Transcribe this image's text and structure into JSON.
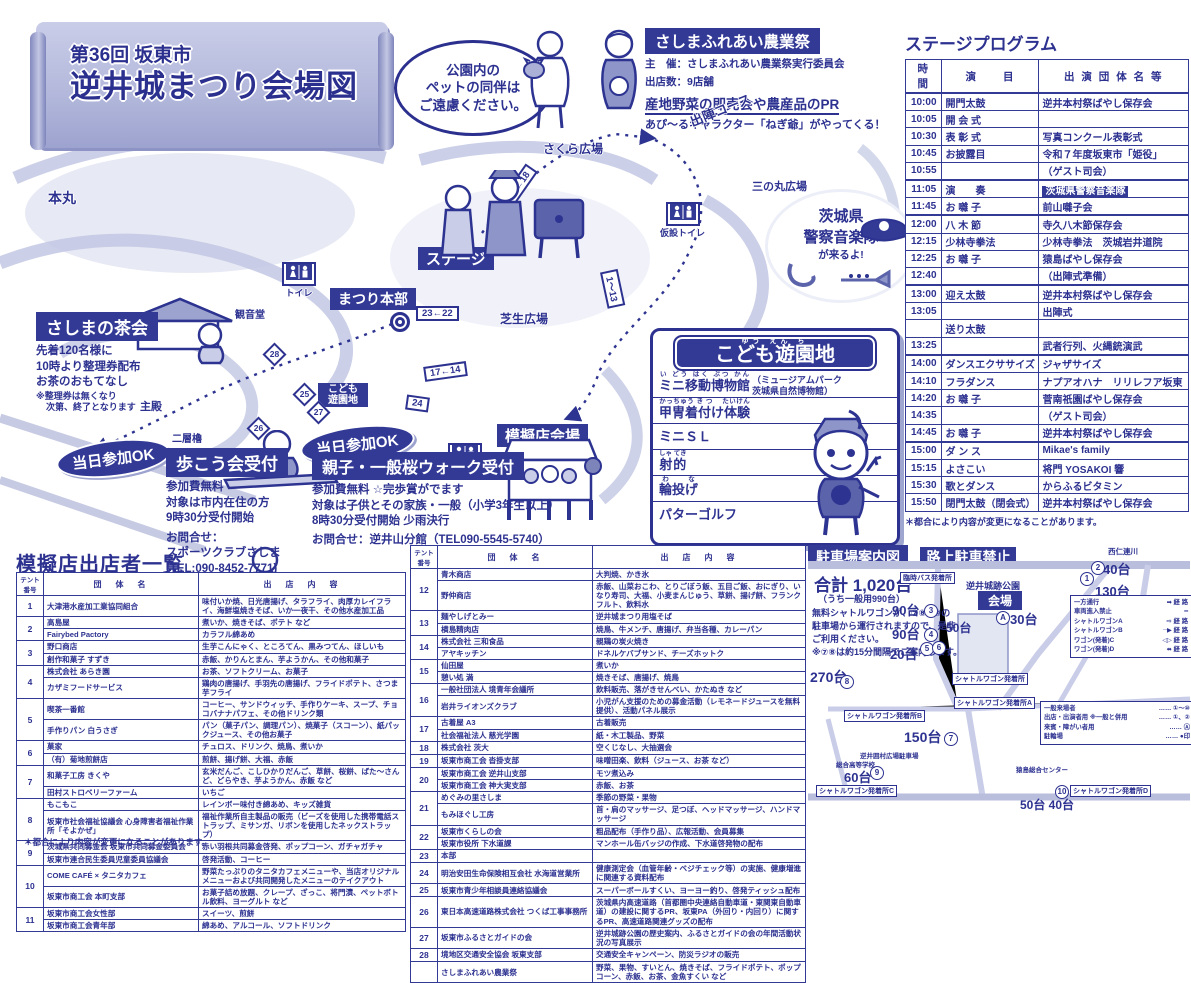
{
  "title": {
    "line1": "第36回 坂東市",
    "line2": "逆井城まつり会場図"
  },
  "pet_notice": {
    "line1": "公園内の",
    "line2": "ペットの同伴は",
    "line3": "ご遠慮ください。"
  },
  "farm_festival": {
    "title": "さしまふれあい農業祭",
    "organizer": "主　催：さしまふれあい農業祭実行委員会",
    "booths": "出店数：9店舗",
    "highlight": "産地野菜の即売会や農産品のPR",
    "note": "あぴ〜るキャラクター「ねぎ爺」がやってくる！"
  },
  "band_balloon": {
    "line1": "茨城県",
    "line2": "警察音楽隊",
    "line3": "が来るよ!"
  },
  "map": {
    "labels": {
      "honmaru": "本丸",
      "sakura": "さくら広場",
      "sannomaru": "三の丸広場",
      "course": "出陣コース",
      "stage": "ステージ",
      "hq": "まつり本部",
      "lawn": "芝生広場",
      "mogiten": "模擬店会場",
      "kannondo": "観音堂",
      "shuden": "主殿",
      "yagura": "二層櫓",
      "toilet": "トイレ",
      "kasetsu1": "仮設トイレ",
      "kasetsu2": "仮設トイレ",
      "kids_small": "こども遊園地"
    },
    "markers": [
      "21←18",
      "23←22",
      "17←14",
      "24",
      "25",
      "26",
      "27",
      "28",
      "1〜13"
    ]
  },
  "tea_party": {
    "title": "さしまの茶会",
    "line1": "先着120名様に",
    "line2": "10時より整理券配布",
    "line3": "お茶のおもてなし",
    "note1": "※整理券は無くなり",
    "note2": "次第、終了となります"
  },
  "walk": {
    "badge": "当日参加OK",
    "title": "歩こう会受付",
    "line1": "参加費無料",
    "line2": "対象は市内在住の方",
    "line3": "9時30分受付開始",
    "contact1": "お問合せ：",
    "contact2": "スポーツクラブさしま",
    "contact3": "(TEL:090-8452-7771)"
  },
  "sakura_walk": {
    "badge": "当日参加OK",
    "title": "親子・一般桜ウォーク受付",
    "line1": "参加費無料 ☆完歩賞がでます",
    "line2": "対象は子供とその家族・一般（小学3年生以上）",
    "line3": "8時30分受付開始 少雨決行",
    "contact": "お問合せ：逆井山分館（TEL090-5545-5740）"
  },
  "kids_park": {
    "title": "こども遊園地",
    "title_ruby": "ゆう えん ち",
    "items": [
      {
        "text": "ミニ移動博物館",
        "ruby": "い どう はく ぶつ かん",
        "note1": "（ミュージアムパーク",
        "note2": "茨城県自然博物館）"
      },
      {
        "text": "甲冑着付け体験",
        "ruby": "かっちゅう き つ　 たいけん"
      },
      {
        "text": "ミニＳＬ",
        "ruby": ""
      },
      {
        "text": "射的",
        "ruby": "しゃ てき"
      },
      {
        "text": "輪投げ",
        "ruby": "わ　な"
      },
      {
        "text": "パターゴルフ",
        "ruby": ""
      }
    ]
  },
  "stage_program": {
    "title": "ステージプログラム",
    "columns": [
      "時　間",
      "演　　目",
      "出 演 団 体 名 等"
    ],
    "note": "＊都合により内容が変更になることがあります。",
    "rows": [
      {
        "t": "10:00",
        "p": "開門太鼓",
        "g": "逆井本村祭ばやし保存会",
        "s": true
      },
      {
        "t": "10:05",
        "p": "開 会 式",
        "g": ""
      },
      {
        "t": "10:30",
        "p": "表 彰 式",
        "g": "写真コンクール表彰式"
      },
      {
        "t": "10:45",
        "p": "お披露目",
        "g": "令和７年度坂東市「姫役」"
      },
      {
        "t": "10:55",
        "p": "",
        "g": "（ゲスト司会）"
      },
      {
        "t": "11:05",
        "p": "演　　奏",
        "g": "茨城県警察音楽隊",
        "h": true,
        "s": true
      },
      {
        "t": "11:45",
        "p": "お 囃 子",
        "g": "前山囃子会"
      },
      {
        "t": "12:00",
        "p": "八 木 節",
        "g": "寺久八木節保存会",
        "s": true
      },
      {
        "t": "12:15",
        "p": "少林寺拳法",
        "g": "少林寺拳法　茨城岩井道院"
      },
      {
        "t": "12:25",
        "p": "お 囃 子",
        "g": "猿島ばやし保存会"
      },
      {
        "t": "12:40",
        "p": "",
        "g": "（出陣式準備）"
      },
      {
        "t": "13:00",
        "p": "迎え太鼓",
        "g": "逆井本村祭ばやし保存会",
        "s": true
      },
      {
        "t": "13:05",
        "p": "",
        "g": "出陣式"
      },
      {
        "t": "",
        "p": "送り太鼓",
        "g": ""
      },
      {
        "t": "13:25",
        "p": "",
        "g": "武者行列、火縄銃演武"
      },
      {
        "t": "14:00",
        "p": "ダンスエクササイズ",
        "g": "ジャザサイズ",
        "s": true
      },
      {
        "t": "14:10",
        "p": "フラダンス",
        "g": "ナプアオハナ　リリレフア坂東"
      },
      {
        "t": "14:20",
        "p": "お 囃 子",
        "g": "菅南祇園ばやし保存会"
      },
      {
        "t": "14:35",
        "p": "",
        "g": "（ゲスト司会）"
      },
      {
        "t": "14:45",
        "p": "お 囃 子",
        "g": "逆井本村祭ばやし保存会"
      },
      {
        "t": "15:00",
        "p": "ダ ン ス",
        "g": "Mikae's family",
        "s": true
      },
      {
        "t": "15:15",
        "p": "よさこい",
        "g": "将門 YOSAKOI 響"
      },
      {
        "t": "15:30",
        "p": "歌とダンス",
        "g": "からふるビタミン"
      },
      {
        "t": "15:50",
        "p": "閉門太鼓（閉会式）",
        "g": "逆井本村祭ばやし保存会"
      }
    ]
  },
  "vendor_list": {
    "title": "模擬店出店者一覧",
    "note": "＊都合により内容が変更になることがあります。",
    "columns": [
      "テント番号",
      "団　体　名",
      "出　店　内　容"
    ],
    "left_groups": [
      {
        "no": "1",
        "rows": [
          {
            "name": "大津港水産加工業協同組合",
            "items": "味付いか焼、日光唐揚げ、タラフライ、肉厚カレイフライ、海鮮塩焼きそば、いか一夜干、その他水産加工品"
          }
        ]
      },
      {
        "no": "2",
        "rows": [
          {
            "name": "高島屋",
            "items": "煮いか、焼きそば、ポテト など"
          },
          {
            "name": "Fairybed Pactory",
            "items": "カラフル綿あめ"
          }
        ]
      },
      {
        "no": "3",
        "rows": [
          {
            "name": "野口商店",
            "items": "生芋こんにゃく、ところてん、黒みつてん、ほしいも"
          },
          {
            "name": "創作和菓子 すずき",
            "items": "赤飯、かりんとまん、芋ようかん、その他和菓子"
          }
        ]
      },
      {
        "no": "4",
        "rows": [
          {
            "name": "株式会社 あらき園",
            "items": "お茶、ソフトクリーム、お菓子"
          },
          {
            "name": "カザミフードサービス",
            "items": "鶏肉の唐揚げ、手羽先の唐揚げ、フライドポテト、さつま芋フライ"
          }
        ]
      },
      {
        "no": "5",
        "rows": [
          {
            "name": "喫茶一番館",
            "items": "コーヒー、サンドウィッチ、手作りケーキ、スープ、チョコバナナパフェ、その他ドリンク類"
          },
          {
            "name": "手作りパン 白うさぎ",
            "items": "パン（菓子パン、調理パン）、焼菓子（スコーン）、紙パックジュース、その他お菓子"
          }
        ]
      },
      {
        "no": "6",
        "rows": [
          {
            "name": "菓家",
            "items": "チュロス、ドリンク、焼鳥、煮いか"
          },
          {
            "name": "（有）菊地煎餅店",
            "items": "煎餅、揚げ餅、大福、赤飯"
          }
        ]
      },
      {
        "no": "7",
        "rows": [
          {
            "name": "和菓子工房 きくや",
            "items": "玄米だんご、こしひかりだんご、草餅、桜餅、ばた〜さんど、どらやき、芋ようかん、赤飯 など"
          },
          {
            "name": "田村ストロベリーファーム",
            "items": "いちご"
          }
        ]
      },
      {
        "no": "8",
        "rows": [
          {
            "name": "もこもこ",
            "items": "レインボー味付き綿あめ、キッズ雑貨"
          },
          {
            "name": "坂東市社会福祉協議会 心身障害者福祉作業所「そよかぜ」",
            "items": "福祉作業所自主製品の販売（ビーズを使用した携帯電話ストラップ、ミサンガ、リボンを使用したネックストラップ）"
          }
        ]
      },
      {
        "no": "9",
        "rows": [
          {
            "name": "茨城県共同募金会 坂東市共同募金委員会",
            "items": "赤い羽根共同募金啓発、ポップコーン、ガチャガチャ"
          },
          {
            "name": "坂東市連合民生委員児童委員協議会",
            "items": "啓発活動、コーヒー"
          }
        ]
      },
      {
        "no": "10",
        "rows": [
          {
            "name": "COME CAFÉ × タニタカフェ",
            "items": "野菜たっぷりのタニタカフェメニューや、当店オリジナルメニューおよび共同開発したメニューのテイクアウト"
          },
          {
            "name": "坂東市商工会 本町支部",
            "items": "お菓子詰め放題、クレープ、ざっこ、将門漬、ペットボトル飲料、ヨーグルト など"
          }
        ]
      },
      {
        "no": "11",
        "rows": [
          {
            "name": "坂東市商工会女性部",
            "items": "スイーツ、煎餅"
          },
          {
            "name": "坂東市商工会青年部",
            "items": "綿あめ、アルコール、ソフトドリンク"
          }
        ]
      }
    ],
    "right_groups": [
      {
        "no": "12",
        "rows": [
          {
            "name": "青木商店",
            "items": "大判焼、かき氷"
          },
          {
            "name": "野仲商店",
            "items": "赤飯、山菜おこわ、とりごぼう飯、五目ご飯、おにぎり、いなり寿司、大福、小麦まんじゅう、草餅、揚げ餅、フランクフルト、飲料水"
          }
        ]
      },
      {
        "no": "13",
        "rows": [
          {
            "name": "麺やしげとみー",
            "items": "逆井城まつり用塩そば"
          },
          {
            "name": "横島精肉店",
            "items": "焼鳥、牛メンチ、唐揚げ、弁当各種、カレーパン"
          }
        ]
      },
      {
        "no": "14",
        "rows": [
          {
            "name": "株式会社 三和食品",
            "items": "親鶏の炭火焼き"
          },
          {
            "name": "アヤキッチン",
            "items": "ドネルケバブサンド、チーズホットク"
          }
        ]
      },
      {
        "no": "15",
        "rows": [
          {
            "name": "仙田屋",
            "items": "煮いか"
          },
          {
            "name": "憩い処 満",
            "items": "焼きそば、唐揚げ、焼鳥"
          }
        ]
      },
      {
        "no": "16",
        "rows": [
          {
            "name": "一般社団法人 境青年会議所",
            "items": "飲料販売、落がきせんべい、かたぬき など"
          },
          {
            "name": "岩井ライオンズクラブ",
            "items": "小児がん支援のための募金活動（レモネードジュースを無料提供）、活動パネル展示"
          }
        ]
      },
      {
        "no": "17",
        "rows": [
          {
            "name": "古着屋 A3",
            "items": "古着販売"
          },
          {
            "name": "社会福祉法人 慈光学園",
            "items": "紙・木工製品、野菜"
          }
        ]
      },
      {
        "no": "18",
        "rows": [
          {
            "name": "株式会社 茨大",
            "items": "空くじなし、大抽選会"
          }
        ]
      },
      {
        "no": "19",
        "rows": [
          {
            "name": "坂東市商工会 沓掛支部",
            "items": "味噌田楽、飲料（ジュース、お茶 など）"
          }
        ]
      },
      {
        "no": "20",
        "rows": [
          {
            "name": "坂東市商工会 逆井山支部",
            "items": "モツ煮込み"
          },
          {
            "name": "坂東市商工会 神大実支部",
            "items": "赤飯、お茶"
          }
        ]
      },
      {
        "no": "21",
        "rows": [
          {
            "name": "めぐみの里さしま",
            "items": "季節の野菜・果物"
          },
          {
            "name": "もみほぐし工房",
            "items": "首・肩のマッサージ、足つぼ、ヘッドマッサージ、ハンドマッサージ"
          }
        ]
      },
      {
        "no": "22",
        "rows": [
          {
            "name": "坂東市くらしの会",
            "items": "粗品配布（手作り品）、広報活動、会員募集"
          },
          {
            "name": "坂東市役所 下水道課",
            "items": "マンホール缶バッジの作成、下水道啓発物の配布"
          }
        ]
      },
      {
        "no": "23",
        "rows": [
          {
            "name": "本部",
            "items": ""
          }
        ]
      },
      {
        "no": "24",
        "rows": [
          {
            "name": "明治安田生命保険相互会社 水海道営業所",
            "items": "健康測定会（血管年齢・ベジチェック等）の実施、健康増進に関連する資料配布"
          }
        ]
      },
      {
        "no": "25",
        "rows": [
          {
            "name": "坂東市青少年相談員連絡協議会",
            "items": "スーパーボールすくい、ヨーヨー釣り、啓発ティッシュ配布"
          }
        ]
      },
      {
        "no": "26",
        "rows": [
          {
            "name": "東日本高速道路株式会社 つくば工事事務所",
            "items": "茨城県内高速道路（首都圏中央連絡自動車道・東関東自動車道）の建設に関するPR、坂東PA（外回り・内回り）に関するPR、高速道路関連グッズの配布"
          }
        ]
      },
      {
        "no": "27",
        "rows": [
          {
            "name": "坂東市ふるさとガイドの会",
            "items": "逆井城跡公園の歴史案内、ふるさとガイドの会の年間活動状況の写真展示"
          }
        ]
      },
      {
        "no": "28",
        "rows": [
          {
            "name": "境地区交通安全協会 坂東支部",
            "items": "交通安全キャンペーン、防災ラジオの販売"
          }
        ]
      },
      {
        "no": "",
        "rows": [
          {
            "name": "さしまふれあい農業祭",
            "items": "野菜、果物、すいとん、焼きそば、フライドポテト、ポップコーン、赤飯、お茶、金魚すくい など"
          }
        ]
      }
    ]
  },
  "parking": {
    "title": "駐車場案内図",
    "banner": "路上駐車禁止",
    "total": "合計 1,020台",
    "total_sub": "（うち一般用990台）",
    "shuttle1": "無料シャトルワゴンが、⑦⑧⑨⑩の",
    "shuttle2": "駐車場から運行されますので、是非",
    "shuttle3": "ご利用ください。",
    "shuttle4": "※⑦⑧は約15分間隔でご案内します。",
    "park_name": "逆井城跡公園",
    "venue": "会場",
    "bus_stop": "臨時バス発着所",
    "river": "西仁連川",
    "lots": [
      {
        "num": "2",
        "count": "40台"
      },
      {
        "num": "1",
        "count": "130台"
      },
      {
        "num": "3",
        "count": "90台"
      },
      {
        "num": "4",
        "count": "90台"
      },
      {
        "num": "5",
        "count": "20台"
      },
      {
        "num": "A",
        "count": "30台"
      },
      {
        "num": "6",
        "count": "50台"
      },
      {
        "num": "8",
        "count": "270台"
      },
      {
        "num": "7",
        "count": "150台"
      },
      {
        "num": "9",
        "count": "60台"
      },
      {
        "num": "10",
        "count": "50台 40台"
      }
    ],
    "stops": [
      "シャトルワゴン発着所",
      "シャトルワゴン発着所A",
      "シャトルワゴン発着所B",
      "シャトルワゴン発着所C",
      "シャトルワゴン発着所D"
    ],
    "legend_route": [
      {
        "label": "一方通行",
        "sym": "➡",
        "suffix": "経 路"
      },
      {
        "label": "車両進入禁止",
        "sym": "━",
        "suffix": ""
      },
      {
        "label": "シャトルワゴンA",
        "sym": "⇨",
        "suffix": "経 路"
      },
      {
        "label": "シャトルワゴンB",
        "sym": "┈▶",
        "suffix": "経 路"
      },
      {
        "label": "ワゴン(発着)C",
        "sym": "◁▷",
        "suffix": "経 路"
      },
      {
        "label": "ワゴン(発着)D",
        "sym": "⬌",
        "suffix": "経 路"
      }
    ],
    "legend_users": [
      {
        "label": "一般来場者",
        "value": "①〜⑩"
      },
      {
        "label": "出店・出演者用 ※一般と併用",
        "value": "①、②"
      },
      {
        "label": "来賓・障がい者用",
        "value": "Ⓐ"
      },
      {
        "label": "駐輪場",
        "value": "●印"
      }
    ],
    "landmarks": [
      "逆井囲村広場駐車場",
      "総合高等学校",
      "猿島総合センター"
    ]
  }
}
